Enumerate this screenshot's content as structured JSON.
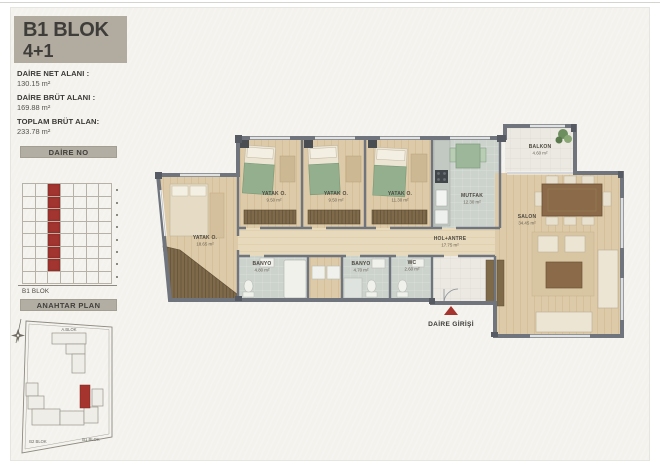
{
  "header": {
    "title": "B1 BLOK",
    "subtitle": "4+1"
  },
  "stats": {
    "net_label": "DAİRE NET ALANI :",
    "net_value": "130.15 m²",
    "brut_label": "DAİRE BRÜT ALANI :",
    "brut_value": "169.88 m²",
    "toplam_label": "TOPLAM BRÜT ALAN:",
    "toplam_value": "233.78 m²"
  },
  "daire_no": {
    "header": "DAİRE NO",
    "block_label": "B1 BLOK",
    "grid": {
      "cols": 7,
      "rows": 8,
      "red_col": 2,
      "red_rows": 7
    }
  },
  "anahtar": {
    "header": "ANAHTAR PLAN",
    "top_label": "A.BLOK",
    "bottom_left_label": "B2 BLOK",
    "bottom_right_label": "B1 BLOK"
  },
  "plan": {
    "entrance": "DAİRE GİRİŞİ",
    "rooms": {
      "master": {
        "name": "YATAK O.",
        "area": "18.65 m²"
      },
      "bed1": {
        "name": "YATAK O.",
        "area": "9.50 m²"
      },
      "bed2": {
        "name": "YATAK O.",
        "area": "9.50 m²"
      },
      "bed3": {
        "name": "YATAK O.",
        "area": "11.30 m²"
      },
      "mutfak": {
        "name": "MUTFAK",
        "area": "12.30 m²"
      },
      "balkon": {
        "name": "BALKON",
        "area": "4.60 m²"
      },
      "salon": {
        "name": "SALON",
        "area": "34.45 m²"
      },
      "hol": {
        "name": "HOL+ANTRE",
        "area": "17.75 m²"
      },
      "banyo1": {
        "name": "BANYO",
        "area": "4.80 m²"
      },
      "banyo2": {
        "name": "BANYO",
        "area": "4.70 m²"
      },
      "wc": {
        "name": "WC",
        "area": "2.60 m²"
      }
    }
  },
  "colors": {
    "accent_red": "#a5332e",
    "wall": "#6f747d",
    "header_bg": "#b2aca0"
  }
}
